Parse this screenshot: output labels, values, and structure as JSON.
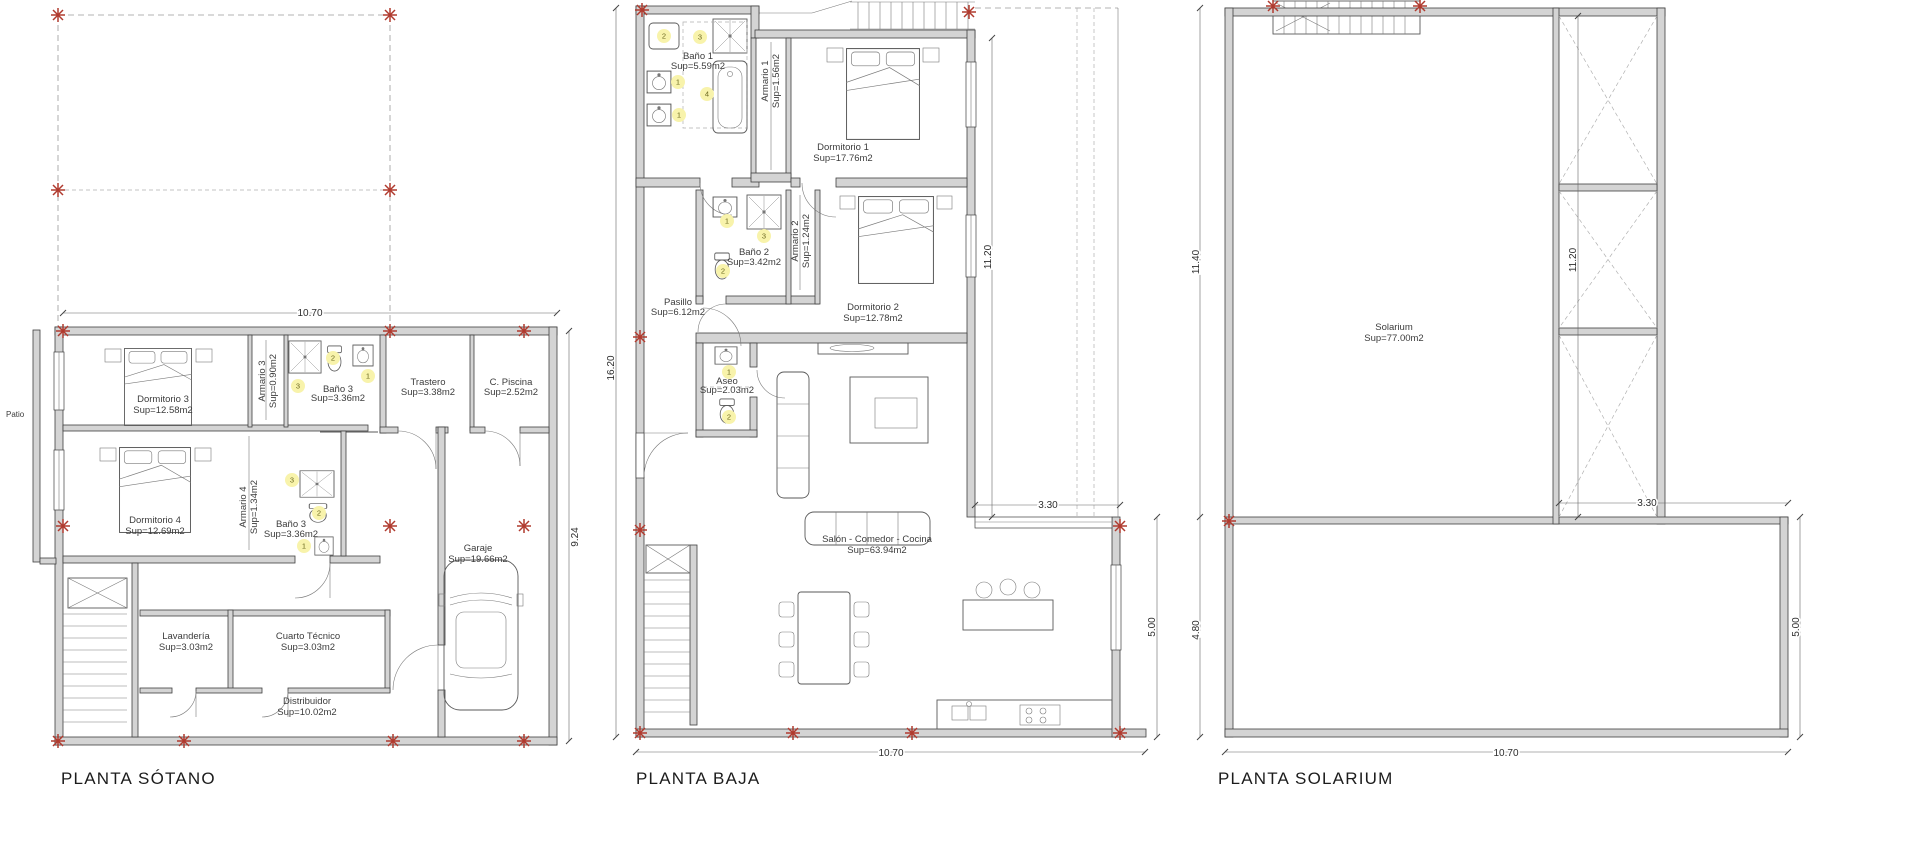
{
  "colors": {
    "wall_fill": "#d4d4d4",
    "line": "#3f3f3f",
    "marker_red": "#b03a2e",
    "badge_yellow": "#f8f3ab",
    "text": "#3c3c3c"
  },
  "plans": [
    {
      "title": "PLANTA SÓTANO",
      "side_label": "Patio",
      "dimensions": {
        "top": "10.70",
        "right": "9.24"
      },
      "rooms": [
        {
          "name": "Dormitorio 3",
          "area": "Sup=12.58m2"
        },
        {
          "name": "Armario 3",
          "area": "Sup=0.90m2"
        },
        {
          "name": "Baño 3",
          "area": "Sup=3.36m2"
        },
        {
          "name": "Trastero",
          "area": "Sup=3.38m2"
        },
        {
          "name": "C. Piscina",
          "area": "Sup=2.52m2"
        },
        {
          "name": "Dormitorio 4",
          "area": "Sup=12.69m2"
        },
        {
          "name": "Armario 4",
          "area": "Sup=1.34m2"
        },
        {
          "name": "Baño 3",
          "area": "Sup=3.36m2"
        },
        {
          "name": "Garaje",
          "area": "Sup=19.66m2"
        },
        {
          "name": "Lavandería",
          "area": "Sup=3.03m2"
        },
        {
          "name": "Cuarto Técnico",
          "area": "Sup=3.03m2"
        },
        {
          "name": "Distribuidor",
          "area": "Sup=10.02m2"
        }
      ],
      "badges": [
        "2",
        "1",
        "3",
        "3",
        "2",
        "1"
      ]
    },
    {
      "title": "PLANTA BAJA",
      "dimensions": {
        "left": "16.20",
        "right_upper": "11.20",
        "porch": "3.30",
        "right_lower": "5.00",
        "bottom": "10.70"
      },
      "rooms": [
        {
          "name": "Baño 1",
          "area": "Sup=5.59m2"
        },
        {
          "name": "Armario 1",
          "area": "Sup=1.56m2"
        },
        {
          "name": "Dormitorio 1",
          "area": "Sup=17.76m2"
        },
        {
          "name": "Baño 2",
          "area": "Sup=3.42m2"
        },
        {
          "name": "Armario 2",
          "area": "Sup=1.24m2"
        },
        {
          "name": "Dormitorio 2",
          "area": "Sup=12.78m2"
        },
        {
          "name": "Pasillo",
          "area": "Sup=6.12m2"
        },
        {
          "name": "Aseo",
          "area": "Sup=2.03m2"
        },
        {
          "name": "Salón - Comedor - Cocina",
          "area": "Sup=63.94m2"
        }
      ],
      "badges": [
        "2",
        "3",
        "1",
        "4",
        "1",
        "1",
        "3",
        "2",
        "1",
        "2"
      ]
    },
    {
      "title": "PLANTA SOLARIUM",
      "dimensions": {
        "left_upper": "11.40",
        "inner_right": "11.20",
        "notch": "3.30",
        "left_lower": "4.80",
        "right_lower": "5.00",
        "bottom": "10.70"
      },
      "rooms": [
        {
          "name": "Solarium",
          "area": "Sup=77.00m2"
        }
      ]
    }
  ]
}
